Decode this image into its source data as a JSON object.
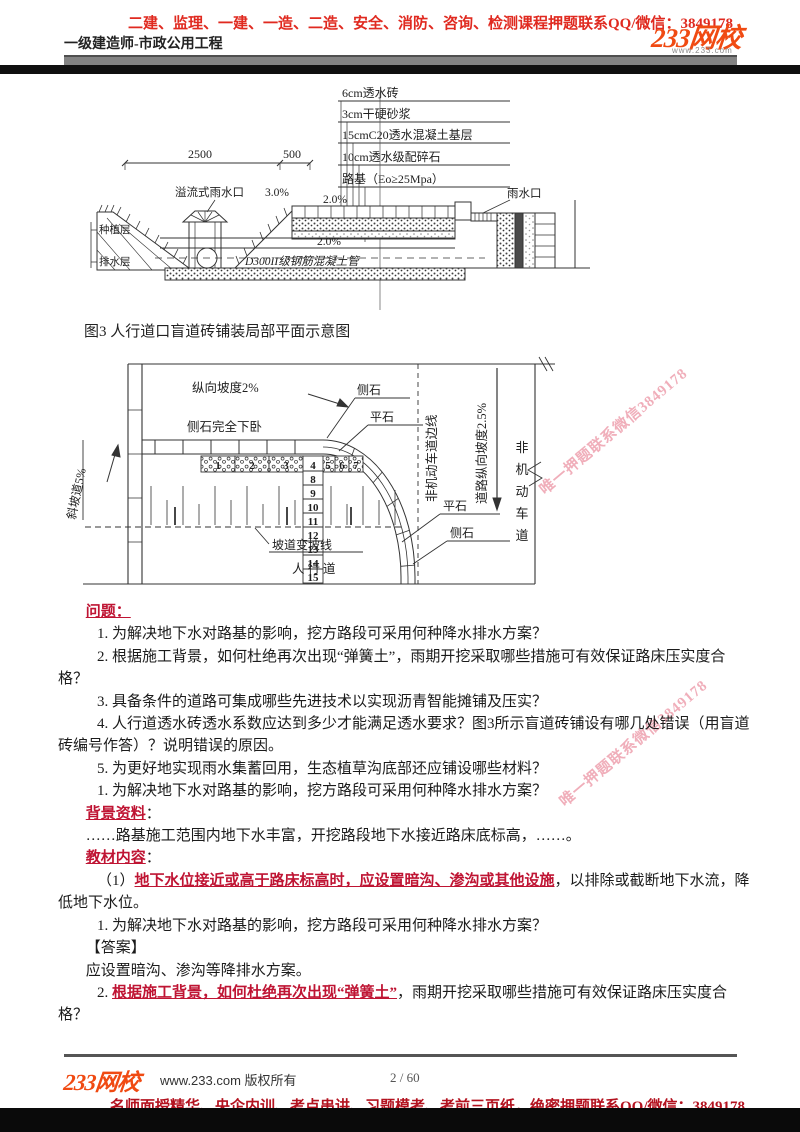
{
  "header": {
    "promo": "二建、监理、一建、一造、二造、安全、消防、咨询、检测课程押题联系QQ/微信：3849178",
    "subtitle": "一级建造师-市政公用工程",
    "logo": "233网校",
    "logo_sub": "www.233.com"
  },
  "diagram1": {
    "layer_labels": [
      "6cm透水砖",
      "3cm干硬砂浆",
      "15cmC20透水混凝土基层",
      "10cm透水级配碎石",
      "路基（Eo≥25Mpa）"
    ],
    "dim_main": "2500",
    "dim_side": "500",
    "overflow_inlet": "溢流式雨水口",
    "slope_left": "3.0%",
    "slope_upper": "2.0%",
    "slope_lower": "2.0%",
    "rain_inlet": "雨水口",
    "planting_layer": "种植层",
    "drain_layer": "排水层",
    "pipe_label": "D300II级钢筋混凝土管"
  },
  "caption": "图3 人行道口盲道砖铺装局部平面示意图",
  "diagram2": {
    "long_slope": "纵向坡度2%",
    "curb_sunken": "侧石完全下卧",
    "curb_top": "侧石",
    "flat_top": "平石",
    "bike_edge": "非机动车道边线",
    "road_slope": "道路纵向坡度2.5%",
    "bike_lane": "非机动车道",
    "flat_bottom": "平石",
    "curb_bottom": "侧石",
    "ramp": "斜坡道5%",
    "slope_change": "坡道变坡线",
    "sidewalk": "人行道",
    "nums": [
      "1",
      "2",
      "3",
      "4",
      "5",
      "6",
      "7",
      "8",
      "9",
      "10",
      "11",
      "12",
      "13",
      "14",
      "15"
    ]
  },
  "watermark": {
    "text": "唯一押题联系微信3849178"
  },
  "content": {
    "paragraphs": [
      {
        "indent": 1,
        "runs": [
          {
            "t": "问题： ",
            "s": "red"
          }
        ]
      },
      {
        "indent": 2,
        "runs": [
          {
            "t": "1. 为解决地下水对路基的影响，挖方路段可采用何种降水排水方案？",
            "s": ""
          }
        ]
      },
      {
        "indent": 2,
        "runs": [
          {
            "t": "2. 根据施工背景，如何杜绝再次出现“弹簧土”，雨期开挖采取哪些措施可有效保证路床压实度合",
            "s": ""
          }
        ]
      },
      {
        "indent": 0,
        "runs": [
          {
            "t": "格？",
            "s": ""
          }
        ]
      },
      {
        "indent": 2,
        "runs": [
          {
            "t": "3. 具备条件的道路可集成哪些先进技术以实现沥青智能摊铺及压实？",
            "s": ""
          }
        ]
      },
      {
        "indent": 2,
        "runs": [
          {
            "t": "4. 人行道透水砖透水系数应达到多少才能满足透水要求？图3所示盲道砖铺设有哪几处错误（用盲道",
            "s": ""
          }
        ]
      },
      {
        "indent": 0,
        "runs": [
          {
            "t": "砖编号作答）？说明错误的原因。",
            "s": ""
          }
        ]
      },
      {
        "indent": 2,
        "runs": [
          {
            "t": "5. 为更好地实现雨水集蓄回用，生态植草沟底部还应铺设哪些材料？",
            "s": ""
          }
        ]
      },
      {
        "indent": 2,
        "runs": [
          {
            "t": "1. 为解决地下水对路基的影响，挖方路段可采用何种降水排水方案？",
            "s": ""
          }
        ]
      },
      {
        "indent": 1,
        "runs": [
          {
            "t": "背景资料",
            "s": "red"
          },
          {
            "t": "：",
            "s": ""
          }
        ]
      },
      {
        "indent": 1,
        "runs": [
          {
            "t": "……路基施工范围内地下水丰富，开挖路段地下水接近路床底标高，……。",
            "s": ""
          }
        ]
      },
      {
        "indent": 1,
        "runs": [
          {
            "t": "教材内容",
            "s": "red"
          },
          {
            "t": "：",
            "s": ""
          }
        ]
      },
      {
        "indent": 2,
        "runs": [
          {
            "t": "（1）",
            "s": ""
          },
          {
            "t": "地下水位接近或高于路床标高时，应设置暗沟、渗沟或其他设施",
            "s": "red"
          },
          {
            "t": "，以排除或截断地下水流，降",
            "s": ""
          }
        ]
      },
      {
        "indent": 0,
        "runs": [
          {
            "t": "低地下水位。",
            "s": ""
          }
        ]
      },
      {
        "indent": 2,
        "runs": [
          {
            "t": "1. 为解决地下水对路基的影响，挖方路段可采用何种降水排水方案？",
            "s": ""
          }
        ]
      },
      {
        "indent": 1,
        "runs": [
          {
            "t": "【答案】",
            "s": ""
          }
        ]
      },
      {
        "indent": 1,
        "runs": [
          {
            "t": "应设置暗沟、渗沟等降排水方案。",
            "s": ""
          }
        ]
      },
      {
        "indent": 2,
        "runs": [
          {
            "t": "2. ",
            "s": ""
          },
          {
            "t": "根据施工背景，如何杜绝再次出现“弹簧土”",
            "s": "red"
          },
          {
            "t": "，雨期开挖采取哪些措施可有效保证路床压实度合",
            "s": ""
          }
        ]
      },
      {
        "indent": 0,
        "runs": [
          {
            "t": "格？",
            "s": ""
          }
        ]
      }
    ]
  },
  "footer": {
    "logo": "233网校",
    "copyright": "www.233.com 版权所有",
    "page": "2  /  60",
    "promo": "名师面授精华、央企内训、考点串讲、习题模考、考前三页纸，绝密押题联系QQ/微信：3849178"
  }
}
